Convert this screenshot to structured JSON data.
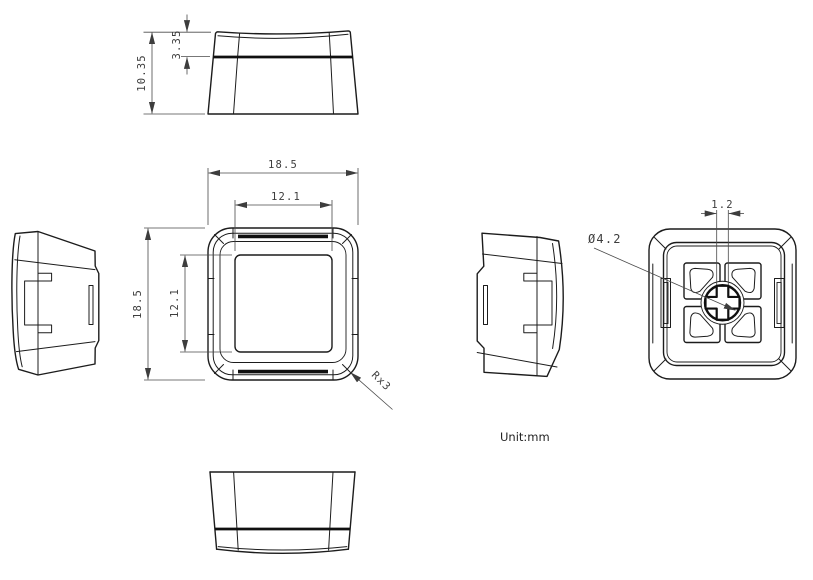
{
  "unit_note": "Unit:mm",
  "dimensions": {
    "total_height": "10.35",
    "top_bevel_height": "3.35",
    "top_outer_width": "18.5",
    "top_inner_width": "12.1",
    "side_outer_depth": "18.5",
    "side_inner_depth": "12.1",
    "corner_radius_note": "Rx3",
    "stem_diameter": "Ø4.2",
    "cross_slot_width": "1.2"
  },
  "colors": {
    "background": "#ffffff",
    "line": "#1c1c1c",
    "dimension_line": "#4a4a4a",
    "dimension_text": "#3d3d3d"
  }
}
